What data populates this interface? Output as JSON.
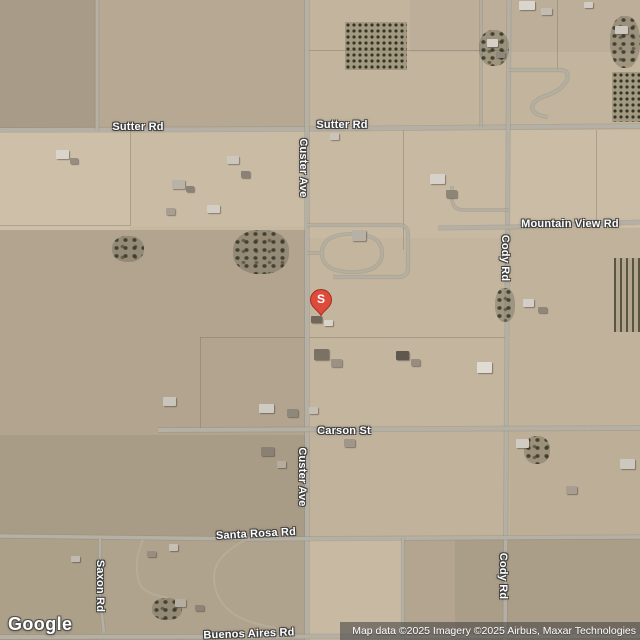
{
  "map": {
    "logo": "Google",
    "attribution": "Map data ©2025 Imagery ©2025 Airbus, Maxar Technologies",
    "marker": {
      "label": "S",
      "x": 321,
      "y": 316,
      "color": "#DE4B3B",
      "stroke": "#9E2F1F"
    },
    "colors": {
      "base": "#c6b8a1",
      "road": "#b5b0a5",
      "road_casing": "#847e70",
      "label_halo": "#3a3a3a"
    },
    "road_labels": [
      {
        "text": "Sutter Rd",
        "x": 138,
        "y": 127,
        "v": 0
      },
      {
        "text": "Sutter Rd",
        "x": 342,
        "y": 125,
        "v": 0
      },
      {
        "text": "Custer Ave",
        "x": 303,
        "y": 168,
        "v": 1
      },
      {
        "text": "Custer Ave",
        "x": 302,
        "y": 477,
        "v": 1
      },
      {
        "text": "Mountain View Rd",
        "x": 570,
        "y": 224,
        "v": 0
      },
      {
        "text": "Cody Rd",
        "x": 505,
        "y": 258,
        "v": 1
      },
      {
        "text": "Cody Rd",
        "x": 503,
        "y": 576,
        "v": 1
      },
      {
        "text": "Carson St",
        "x": 344,
        "y": 431,
        "v": 0
      },
      {
        "text": "Santa Rosa Rd",
        "x": 256,
        "y": 534,
        "v": 0,
        "r": -3
      },
      {
        "text": "Saxon Rd",
        "x": 100,
        "y": 586,
        "v": 1
      },
      {
        "text": "Buenos Aires Rd",
        "x": 249,
        "y": 634,
        "v": 0,
        "r": -2
      }
    ],
    "roads": [
      {
        "n": "sutter-rd",
        "d": "M0,130 L300,129 L640,126",
        "w": 4
      },
      {
        "n": "custer-ave",
        "d": "M307,0 L307,640",
        "w": 4
      },
      {
        "n": "cody-rd",
        "d": "M509,0 L505,640",
        "w": 3.5
      },
      {
        "n": "mountain-view-rd",
        "d": "M438,228 L509,227 L640,222",
        "w": 3.5
      },
      {
        "n": "carson-st",
        "d": "M158,430 L640,428",
        "w": 4
      },
      {
        "n": "santa-rosa-rd",
        "d": "M0,536 L250,539 L640,537",
        "w": 3.5
      },
      {
        "n": "buenos-aires-rd",
        "d": "M0,637 L640,636",
        "w": 4
      },
      {
        "n": "north-road",
        "d": "M97,0 L97,130",
        "w": 3
      },
      {
        "n": "north-driveway",
        "d": "M481,0 L481,127",
        "w": 2.2,
        "o": 0.8
      },
      {
        "n": "saxon-rd",
        "d": "M100,538 L100,598 L104,633",
        "w": 2.6
      },
      {
        "n": "mid-south-road",
        "d": "M403,538 L403,640",
        "w": 2.6
      },
      {
        "n": "loop-outer",
        "d": "M307,225 L398,225 Q408,225 408,234 L408,268 Q408,277 398,277 L333,277",
        "w": 2.6,
        "o": 0.9
      },
      {
        "n": "loop-inner",
        "d": "M307,253 L322,253 Q322,234 352,234 Q382,234 382,253 Q382,272 352,272 Q322,272 322,253",
        "w": 2.4,
        "o": 0.85
      },
      {
        "n": "cody-hook",
        "d": "M509,70 L560,70 Q570,70 567,80 Q562,90 548,95 Q532,100 532,108 Q533,115 548,117",
        "w": 2.6,
        "o": 0.9
      },
      {
        "n": "cody-driveway",
        "d": "M509,210 L464,210 Q452,210 452,198 L452,186",
        "w": 2.2,
        "o": 0.8
      },
      {
        "n": "trail-southwest",
        "d": "M247,539 Q214,556 214,577 Q214,602 237,616 Q252,624 276,628",
        "w": 2,
        "t": 1,
        "o": 0.6
      },
      {
        "n": "trail-saxon-east",
        "d": "M143,540 Q133,561 139,582 Q143,594 168,598",
        "w": 2,
        "t": 1,
        "o": 0.55
      },
      {
        "n": "trail-southeast",
        "d": "M585,415 Q596,445 580,470 Q568,495 576,520",
        "w": 1.6,
        "t": 1,
        "o": 0.4
      }
    ],
    "terrain_patches": [
      {
        "x": 0,
        "y": 0,
        "w": 640,
        "h": 640,
        "c": "#c6b8a1",
        "s": 3
      },
      {
        "x": 0,
        "y": 0,
        "w": 96,
        "h": 130,
        "c": "#a89b87",
        "s": 1
      },
      {
        "x": 96,
        "y": 0,
        "w": 211,
        "h": 130,
        "c": "#b6a893",
        "s": 1
      },
      {
        "x": 307,
        "y": 0,
        "w": 333,
        "h": 130,
        "c": "#c2b49d",
        "s": 2
      },
      {
        "x": 410,
        "y": 0,
        "w": 230,
        "h": 52,
        "c": "#bcae98",
        "s": 1
      },
      {
        "x": 0,
        "y": 130,
        "w": 130,
        "h": 100,
        "c": "#cdbfa8",
        "s": 3
      },
      {
        "x": 130,
        "y": 130,
        "w": 177,
        "h": 96,
        "c": "#c9bba4",
        "s": 2
      },
      {
        "x": 0,
        "y": 230,
        "w": 307,
        "h": 205,
        "c": "#b2a48f",
        "s": 1
      },
      {
        "x": 307,
        "y": 130,
        "w": 203,
        "h": 108,
        "c": "#c7b9a2",
        "s": 2
      },
      {
        "x": 307,
        "y": 238,
        "w": 203,
        "h": 192,
        "c": "#c3b59e",
        "s": 2
      },
      {
        "x": 510,
        "y": 130,
        "w": 130,
        "h": 98,
        "c": "#cabca5",
        "s": 2
      },
      {
        "x": 510,
        "y": 228,
        "w": 130,
        "h": 202,
        "c": "#c0b29b",
        "s": 1
      },
      {
        "x": 0,
        "y": 435,
        "w": 307,
        "h": 205,
        "c": "#a99c86",
        "s": 1
      },
      {
        "x": 307,
        "y": 430,
        "w": 203,
        "h": 108,
        "c": "#c0b29b",
        "s": 1
      },
      {
        "x": 510,
        "y": 430,
        "w": 130,
        "h": 108,
        "c": "#bcae97",
        "s": 1
      },
      {
        "x": 307,
        "y": 538,
        "w": 96,
        "h": 102,
        "c": "#c7b9a2",
        "s": 2
      },
      {
        "x": 403,
        "y": 538,
        "w": 237,
        "h": 102,
        "c": "#b3a590",
        "s": 1
      },
      {
        "x": 0,
        "y": 538,
        "w": 100,
        "h": 102,
        "c": "#aca089",
        "s": 1
      },
      {
        "x": 100,
        "y": 538,
        "w": 207,
        "h": 102,
        "c": "#b0a38d",
        "s": 1
      },
      {
        "x": 455,
        "y": 538,
        "w": 185,
        "h": 102,
        "c": "#ab9e88",
        "s": 1
      }
    ],
    "parcel_lines": [
      {
        "x": 403,
        "y": 129,
        "w": 1,
        "h": 121
      },
      {
        "x": 200,
        "y": 337,
        "w": 1,
        "h": 93
      },
      {
        "x": 200,
        "y": 337,
        "w": 307,
        "h": 1
      },
      {
        "x": 130,
        "y": 130,
        "w": 1,
        "h": 96
      },
      {
        "x": 557,
        "y": 0,
        "w": 1,
        "h": 70
      },
      {
        "x": 305,
        "y": 50,
        "w": 205,
        "h": 1
      },
      {
        "x": 0,
        "y": 225,
        "w": 130,
        "h": 1
      },
      {
        "x": 596,
        "y": 130,
        "w": 1,
        "h": 98
      }
    ],
    "vegetation": [
      {
        "t": "grid",
        "x": 345,
        "y": 22,
        "w": 62,
        "h": 48
      },
      {
        "t": "trees",
        "x": 610,
        "y": 16,
        "w": 30,
        "h": 52
      },
      {
        "t": "grid",
        "x": 612,
        "y": 72,
        "w": 28,
        "h": 50
      },
      {
        "t": "rows",
        "x": 614,
        "y": 258,
        "w": 26,
        "h": 74
      },
      {
        "t": "trees",
        "x": 233,
        "y": 230,
        "w": 56,
        "h": 44
      },
      {
        "t": "trees",
        "x": 479,
        "y": 30,
        "w": 30,
        "h": 36
      },
      {
        "t": "trees",
        "x": 495,
        "y": 288,
        "w": 20,
        "h": 34
      },
      {
        "t": "trees",
        "x": 112,
        "y": 236,
        "w": 32,
        "h": 26
      },
      {
        "t": "trees",
        "x": 524,
        "y": 436,
        "w": 26,
        "h": 28
      },
      {
        "t": "trees",
        "x": 152,
        "y": 598,
        "w": 30,
        "h": 22
      }
    ],
    "buildings": [
      [
        56,
        150,
        13,
        9,
        "#d9d5cd"
      ],
      [
        70,
        158,
        8,
        6,
        "#958d7f"
      ],
      [
        172,
        180,
        13,
        9,
        "#b9b2a6"
      ],
      [
        186,
        186,
        8,
        6,
        "#8a8276"
      ],
      [
        227,
        156,
        12,
        8,
        "#ccc7bd"
      ],
      [
        241,
        171,
        9,
        7,
        "#8a8276"
      ],
      [
        207,
        205,
        13,
        8,
        "#d2cdc5"
      ],
      [
        166,
        208,
        9,
        7,
        "#a89f92"
      ],
      [
        330,
        133,
        9,
        7,
        "#c9c4ba"
      ],
      [
        352,
        230,
        14,
        11,
        "#b7b0a4"
      ],
      [
        430,
        174,
        15,
        10,
        "#d6d2ca"
      ],
      [
        446,
        190,
        11,
        8,
        "#8d8578"
      ],
      [
        519,
        1,
        16,
        9,
        "#dad6ce"
      ],
      [
        541,
        8,
        11,
        7,
        "#c2bcb1"
      ],
      [
        584,
        2,
        9,
        6,
        "#d0ccc4"
      ],
      [
        615,
        26,
        13,
        8,
        "#ccc8c0"
      ],
      [
        487,
        39,
        11,
        8,
        "#d5d1c9"
      ],
      [
        496,
        52,
        9,
        6,
        "#8f8779"
      ],
      [
        311,
        316,
        11,
        7,
        "#6f675a"
      ],
      [
        324,
        320,
        9,
        6,
        "#d8d4cc"
      ],
      [
        314,
        349,
        15,
        11,
        "#7a7265"
      ],
      [
        331,
        359,
        11,
        8,
        "#9b9285"
      ],
      [
        259,
        404,
        15,
        9,
        "#cfcac2"
      ],
      [
        287,
        409,
        11,
        8,
        "#8f8779"
      ],
      [
        309,
        407,
        9,
        7,
        "#c5c0b6"
      ],
      [
        344,
        439,
        11,
        8,
        "#a0978a"
      ],
      [
        261,
        447,
        13,
        9,
        "#8a8174"
      ],
      [
        277,
        461,
        9,
        7,
        "#b5aca0"
      ],
      [
        396,
        351,
        13,
        9,
        "#5f584c"
      ],
      [
        411,
        359,
        9,
        7,
        "#978e81"
      ],
      [
        477,
        362,
        15,
        11,
        "#e0dcd4"
      ],
      [
        516,
        439,
        13,
        9,
        "#d0cbc3"
      ],
      [
        620,
        459,
        15,
        10,
        "#ccc7bf"
      ],
      [
        566,
        486,
        11,
        8,
        "#a79e91"
      ],
      [
        523,
        299,
        11,
        8,
        "#d3cec6"
      ],
      [
        538,
        307,
        9,
        6,
        "#8f8779"
      ],
      [
        163,
        397,
        13,
        9,
        "#cac5bb"
      ],
      [
        169,
        544,
        9,
        7,
        "#c5bfb4"
      ],
      [
        147,
        551,
        9,
        6,
        "#978e81"
      ],
      [
        175,
        599,
        11,
        8,
        "#b4ada1"
      ],
      [
        195,
        605,
        9,
        6,
        "#8d8477"
      ],
      [
        71,
        556,
        9,
        6,
        "#c0bab0"
      ]
    ]
  }
}
